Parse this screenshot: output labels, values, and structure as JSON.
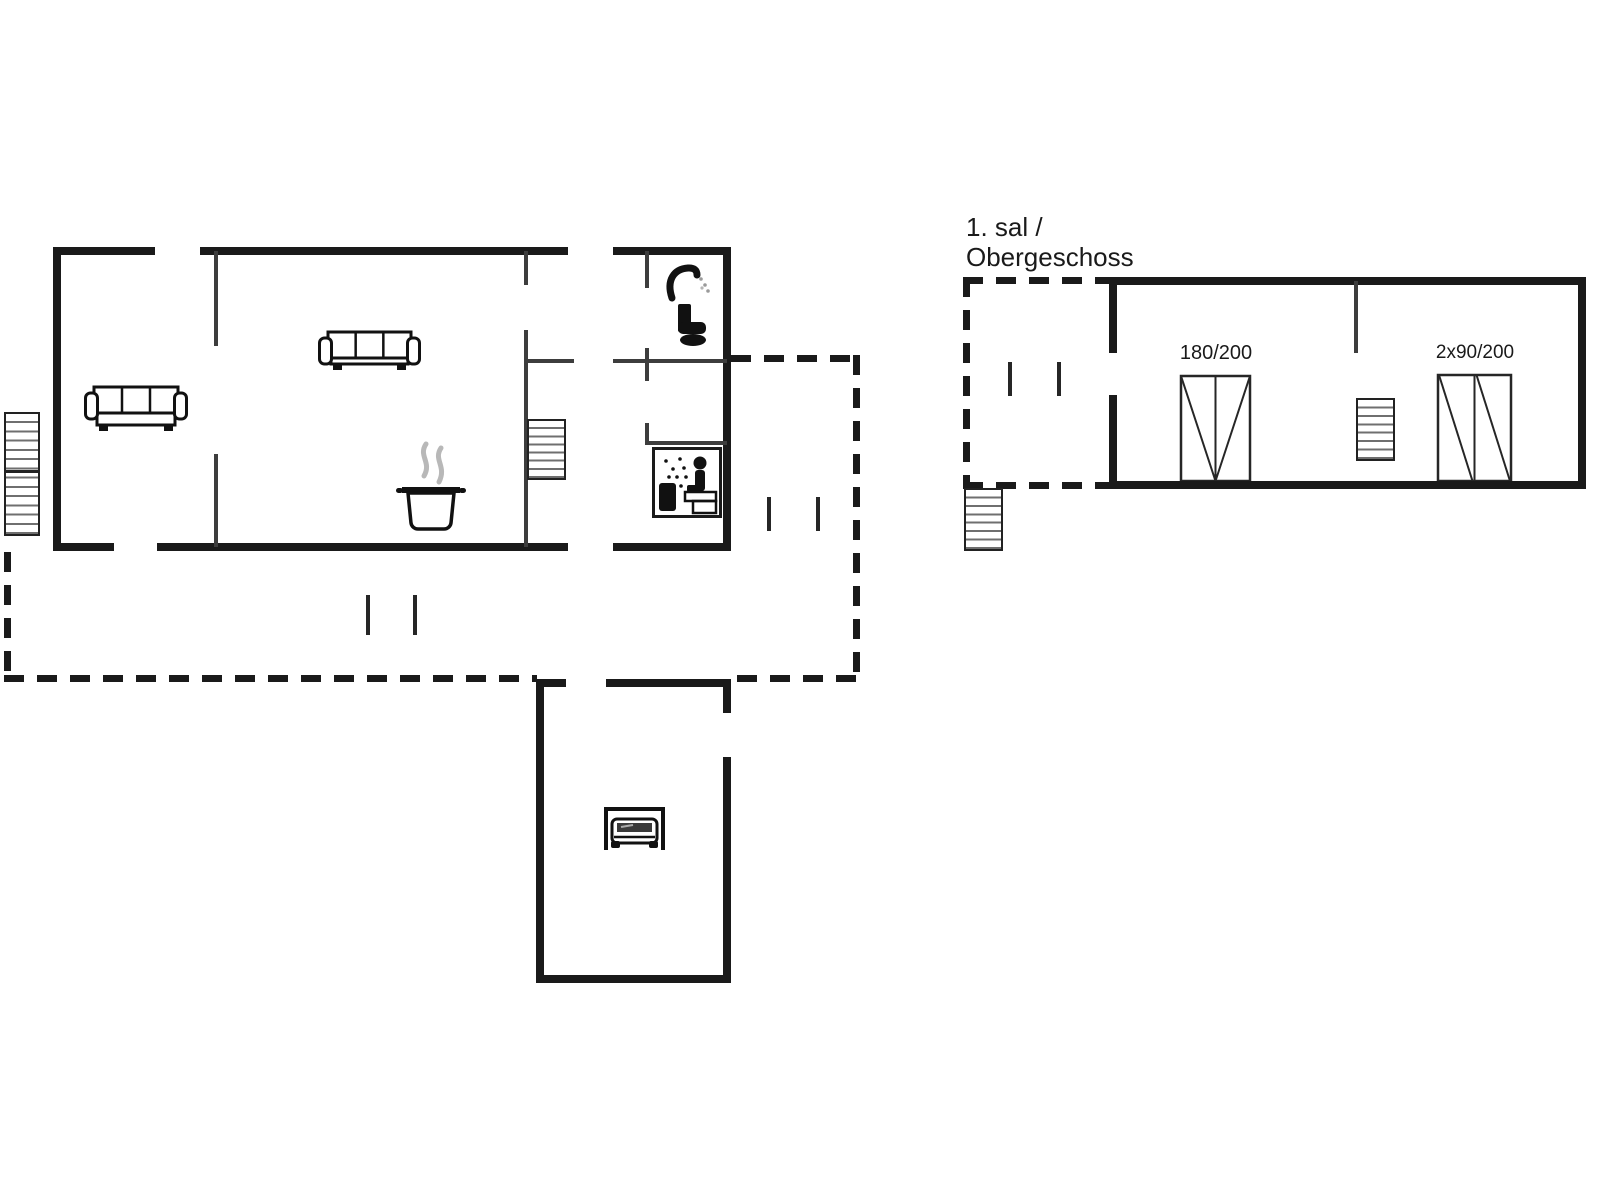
{
  "colors": {
    "wall": "#1a1a1a",
    "thin_wall": "#3d3d3d",
    "marker": "#262626",
    "stair_border": "#222222",
    "icon": "#111111",
    "steam": "#b8b8b8",
    "background": "#ffffff",
    "text": "#1a1a1a"
  },
  "labels": {
    "floor_line1": "1. sal /",
    "floor_line2": "Obergeschoss",
    "bed_double": "180/200",
    "bed_twin": "2x90/200"
  },
  "floorplan": {
    "walls_thick": [
      {
        "x": 55,
        "y": 247,
        "w": 100,
        "h": 8
      },
      {
        "x": 200,
        "y": 247,
        "w": 368,
        "h": 8
      },
      {
        "x": 613,
        "y": 247,
        "w": 118,
        "h": 8
      },
      {
        "x": 53,
        "y": 247,
        "w": 8,
        "h": 303
      },
      {
        "x": 53,
        "y": 543,
        "w": 61,
        "h": 8
      },
      {
        "x": 157,
        "y": 543,
        "w": 411,
        "h": 8
      },
      {
        "x": 613,
        "y": 543,
        "w": 118,
        "h": 8
      },
      {
        "x": 723,
        "y": 247,
        "w": 8,
        "h": 304
      },
      {
        "x": 536,
        "y": 679,
        "w": 8,
        "h": 304
      },
      {
        "x": 536,
        "y": 679,
        "w": 30,
        "h": 8
      },
      {
        "x": 606,
        "y": 679,
        "w": 125,
        "h": 8
      },
      {
        "x": 723,
        "y": 679,
        "w": 8,
        "h": 34
      },
      {
        "x": 723,
        "y": 757,
        "w": 8,
        "h": 226
      },
      {
        "x": 536,
        "y": 975,
        "w": 195,
        "h": 8
      },
      {
        "x": 1109,
        "y": 277,
        "w": 477,
        "h": 8
      },
      {
        "x": 1109,
        "y": 277,
        "w": 8,
        "h": 76
      },
      {
        "x": 1109,
        "y": 395,
        "w": 8,
        "h": 94
      },
      {
        "x": 1578,
        "y": 277,
        "w": 8,
        "h": 212
      },
      {
        "x": 1109,
        "y": 481,
        "w": 477,
        "h": 8
      }
    ],
    "walls_thin": [
      {
        "x": 214,
        "y": 251,
        "w": 4,
        "h": 95
      },
      {
        "x": 214,
        "y": 454,
        "w": 4,
        "h": 93
      },
      {
        "x": 524,
        "y": 251,
        "w": 4,
        "h": 34
      },
      {
        "x": 524,
        "y": 330,
        "w": 4,
        "h": 217
      },
      {
        "x": 524,
        "y": 359,
        "w": 50,
        "h": 4
      },
      {
        "x": 613,
        "y": 359,
        "w": 114,
        "h": 4
      },
      {
        "x": 645,
        "y": 251,
        "w": 4,
        "h": 37
      },
      {
        "x": 645,
        "y": 348,
        "w": 4,
        "h": 33
      },
      {
        "x": 645,
        "y": 423,
        "w": 4,
        "h": 22
      },
      {
        "x": 645,
        "y": 441,
        "w": 82,
        "h": 4
      },
      {
        "x": 1354,
        "y": 281,
        "w": 4,
        "h": 72
      }
    ],
    "door_markers": [
      {
        "x": 366,
        "y": 595,
        "w": 4,
        "h": 40
      },
      {
        "x": 413,
        "y": 595,
        "w": 4,
        "h": 40
      },
      {
        "x": 767,
        "y": 497,
        "w": 4,
        "h": 34
      },
      {
        "x": 816,
        "y": 497,
        "w": 4,
        "h": 34
      },
      {
        "x": 1008,
        "y": 362,
        "w": 4,
        "h": 34
      },
      {
        "x": 1057,
        "y": 362,
        "w": 4,
        "h": 34
      }
    ],
    "dashed_lines": [
      {
        "x": 4,
        "y": 552,
        "w": 7,
        "h": 130,
        "dir": "v"
      },
      {
        "x": 4,
        "y": 675,
        "w": 533,
        "h": 7,
        "dir": "h"
      },
      {
        "x": 731,
        "y": 355,
        "w": 129,
        "h": 7,
        "dir": "h"
      },
      {
        "x": 853,
        "y": 355,
        "w": 7,
        "h": 327,
        "dir": "v"
      },
      {
        "x": 737,
        "y": 675,
        "w": 123,
        "h": 7,
        "dir": "h"
      },
      {
        "x": 963,
        "y": 277,
        "w": 146,
        "h": 7,
        "dir": "h"
      },
      {
        "x": 963,
        "y": 277,
        "w": 7,
        "h": 212,
        "dir": "v"
      },
      {
        "x": 963,
        "y": 482,
        "w": 146,
        "h": 7,
        "dir": "h"
      }
    ],
    "stairs": [
      {
        "name": "entry-stairs-outside",
        "x": 4,
        "y": 412,
        "w": 36,
        "h": 124,
        "treads": 13,
        "split_y": 470,
        "arrows": [
          {
            "cx": 22,
            "tip": 426,
            "tail": 456
          },
          {
            "cx": 22,
            "tip": 484,
            "tail": 518
          }
        ]
      },
      {
        "name": "basement-stairs",
        "x": 527,
        "y": 419,
        "w": 39,
        "h": 61,
        "treads": 7,
        "arrows": [
          {
            "cx": 547,
            "tip": 466,
            "tail": 428
          }
        ]
      },
      {
        "name": "upper-floor-entry-stairs",
        "x": 964,
        "y": 488,
        "w": 39,
        "h": 63,
        "treads": 7,
        "arrows": [
          {
            "cx": 984,
            "tip": 497,
            "tail": 541
          }
        ]
      },
      {
        "name": "upper-floor-stairs",
        "x": 1356,
        "y": 398,
        "w": 39,
        "h": 63,
        "treads": 7,
        "arrows": [
          {
            "cx": 1376,
            "tip": 407,
            "tail": 451
          }
        ]
      }
    ],
    "beds": [
      {
        "name": "bed-double-180x200",
        "style": "double",
        "x": 1180,
        "y": 375,
        "w": 71,
        "h": 107
      },
      {
        "name": "bed-twin-2x90x200",
        "style": "twin",
        "x": 1437,
        "y": 374,
        "w": 75,
        "h": 108
      }
    ],
    "icons": [
      {
        "name": "sofa-icon",
        "glyph": "sofa",
        "x": 84,
        "y": 385,
        "w": 104,
        "h": 48
      },
      {
        "name": "sofa-icon",
        "glyph": "sofa",
        "x": 318,
        "y": 330,
        "w": 103,
        "h": 42
      },
      {
        "name": "cooking-pot-icon",
        "glyph": "pot",
        "x": 396,
        "y": 440,
        "w": 70,
        "h": 90
      },
      {
        "name": "toilet-icon",
        "glyph": "toilet",
        "x": 664,
        "y": 264,
        "w": 50,
        "h": 86
      },
      {
        "name": "sauna-icon",
        "glyph": "sauna",
        "x": 652,
        "y": 447,
        "w": 70,
        "h": 71
      },
      {
        "name": "car-garage-icon",
        "glyph": "car",
        "x": 603,
        "y": 804,
        "w": 63,
        "h": 47
      }
    ]
  }
}
